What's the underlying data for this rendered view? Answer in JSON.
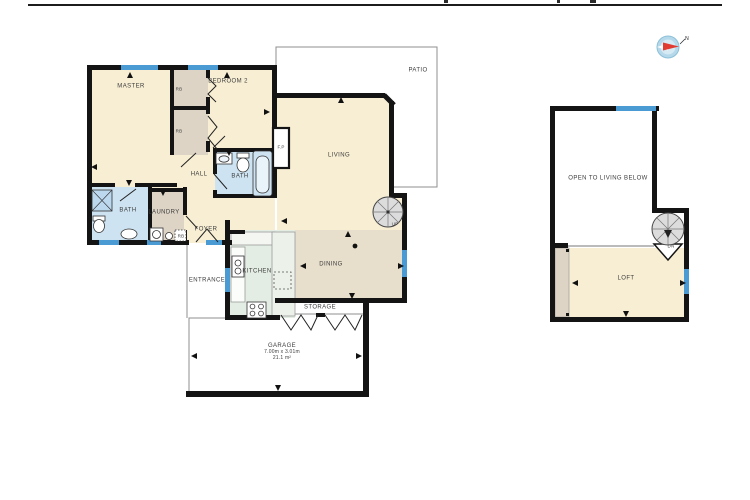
{
  "document": {
    "type": "floor-plan",
    "title_visible": "cut off at top edge (only descenders of title text visible above rule line)"
  },
  "compass": {
    "north_label": "N"
  },
  "main_floor": {
    "rooms": {
      "master": "MASTER",
      "bedroom2": "BEDROOM 2",
      "robe1": "RB",
      "robe2": "RB",
      "hall": "HALL",
      "bath": "BATH",
      "ensuite": "BATH",
      "laundry": "LAUNDRY",
      "laundry_robe": "RB",
      "foyer": "FOYER",
      "entrance": "ENTRANCE",
      "kitchen": "KITCHEN",
      "dining": "DINING",
      "living": "LIVING",
      "patio": "PATIO",
      "storage": "STORAGE",
      "fireplace": "F.P",
      "stair_up": "UP"
    },
    "garage": {
      "name": "GARAGE",
      "dimensions": "7.00m x 3.01m",
      "area": "21.1 m²"
    }
  },
  "upper_floor": {
    "rooms": {
      "open_below": "OPEN TO LIVING BELOW",
      "loft": "LOFT",
      "stair_down": "DN"
    }
  },
  "colors": {
    "room_cream": "#f8eed3",
    "dining_tan": "#e7decb",
    "closet_beige": "#ddd4c6",
    "bath_blue": "#cde3f2",
    "kitchen_mint": "#e4ede4",
    "window_blue": "#4a9bd4",
    "wall_black": "#141414",
    "stair_gray": "#dcdcdc",
    "compass_blue": "#b5d9ea",
    "compass_red": "#e03c31"
  }
}
